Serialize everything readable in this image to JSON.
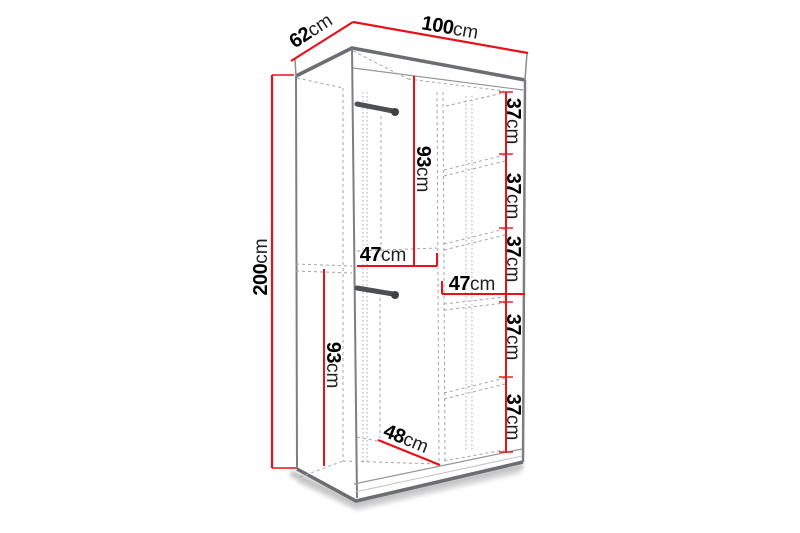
{
  "diagram": {
    "subject": "wardrobe-interior-dimension-diagram",
    "unit": "cm",
    "accent_color": "#e8101b",
    "outline_color": "#6b6d70",
    "dashed_color": "#a2a4a7"
  },
  "labels": {
    "width": {
      "num": "100",
      "unit": "cm"
    },
    "depth": {
      "num": "62",
      "unit": "cm"
    },
    "height": {
      "num": "200",
      "unit": "cm"
    },
    "top_rod_section_height": {
      "num": "93",
      "unit": "cm"
    },
    "bottom_rod_section_height": {
      "num": "93",
      "unit": "cm"
    },
    "left_compartment_width": {
      "num": "47",
      "unit": "cm"
    },
    "right_compartment_width": {
      "num": "47",
      "unit": "cm"
    },
    "usable_depth": {
      "num": "48",
      "unit": "cm"
    },
    "shelf_gaps": [
      {
        "num": "37",
        "unit": "cm"
      },
      {
        "num": "37",
        "unit": "cm"
      },
      {
        "num": "37",
        "unit": "cm"
      },
      {
        "num": "37",
        "unit": "cm"
      },
      {
        "num": "37",
        "unit": "cm"
      }
    ]
  },
  "dimensions_cm": {
    "width": 100,
    "depth": 62,
    "height": 200,
    "top_hanging_section_height": 93,
    "bottom_hanging_section_height": 93,
    "left_compartment_width": 47,
    "right_compartment_width": 47,
    "usable_depth": 48,
    "shelf_spacing": [
      37,
      37,
      37,
      37,
      37
    ]
  }
}
